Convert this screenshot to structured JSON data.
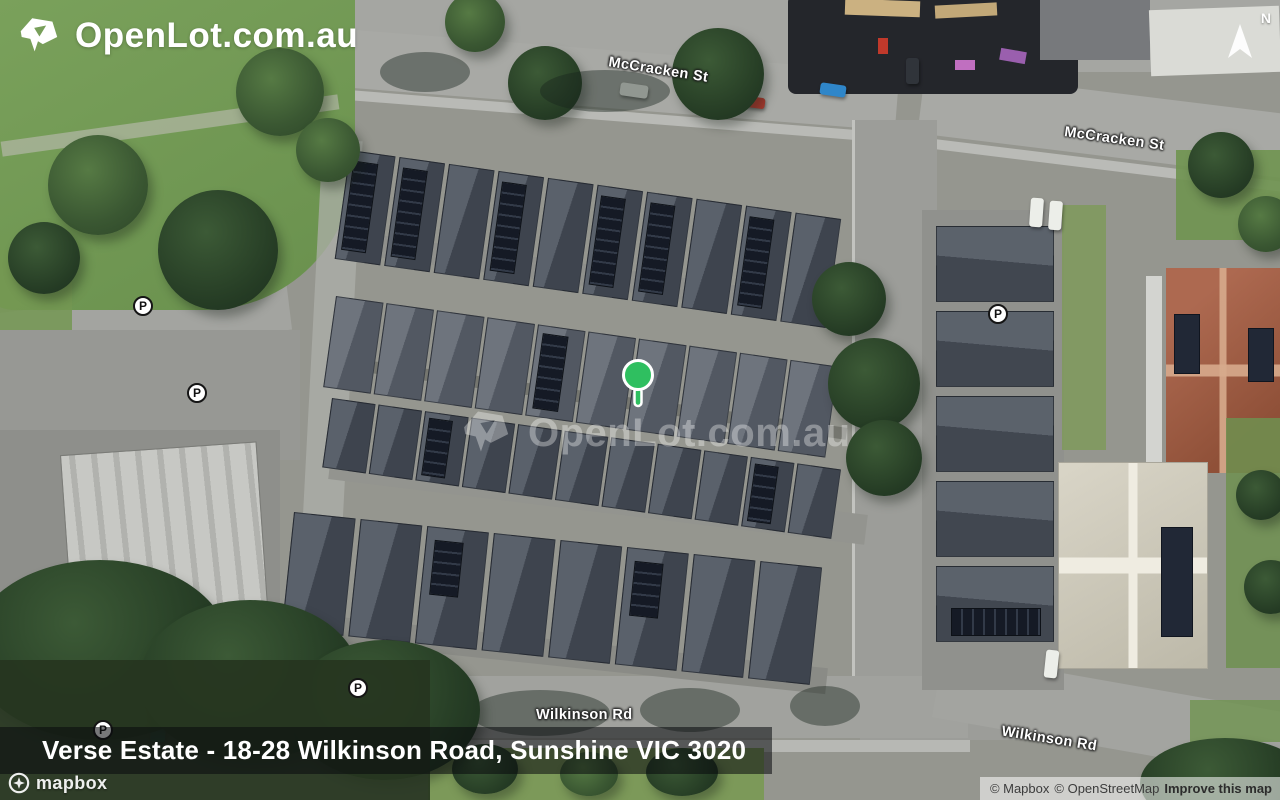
{
  "brand": {
    "logo_text": "OpenLot.com.au"
  },
  "watermark": {
    "text": "OpenLot.com.au"
  },
  "compass": {
    "label": "N"
  },
  "marker": {
    "color": "#2fbf60"
  },
  "street_labels": [
    {
      "text": "McCracken St"
    },
    {
      "text": "McCracken St"
    },
    {
      "text": "Wilkinson Rd"
    },
    {
      "text": "Wilkinson Rd"
    }
  ],
  "parking": {
    "label": "P",
    "count": 5
  },
  "address_bar": {
    "title": "Verse Estate - 18-28 Wilkinson Road, Sunshine VIC 3020"
  },
  "mapbox_logo": {
    "text": "mapbox"
  },
  "attribution": {
    "mapbox": "© Mapbox",
    "osm": "© OpenStreetMap",
    "improve": "Improve this map"
  }
}
